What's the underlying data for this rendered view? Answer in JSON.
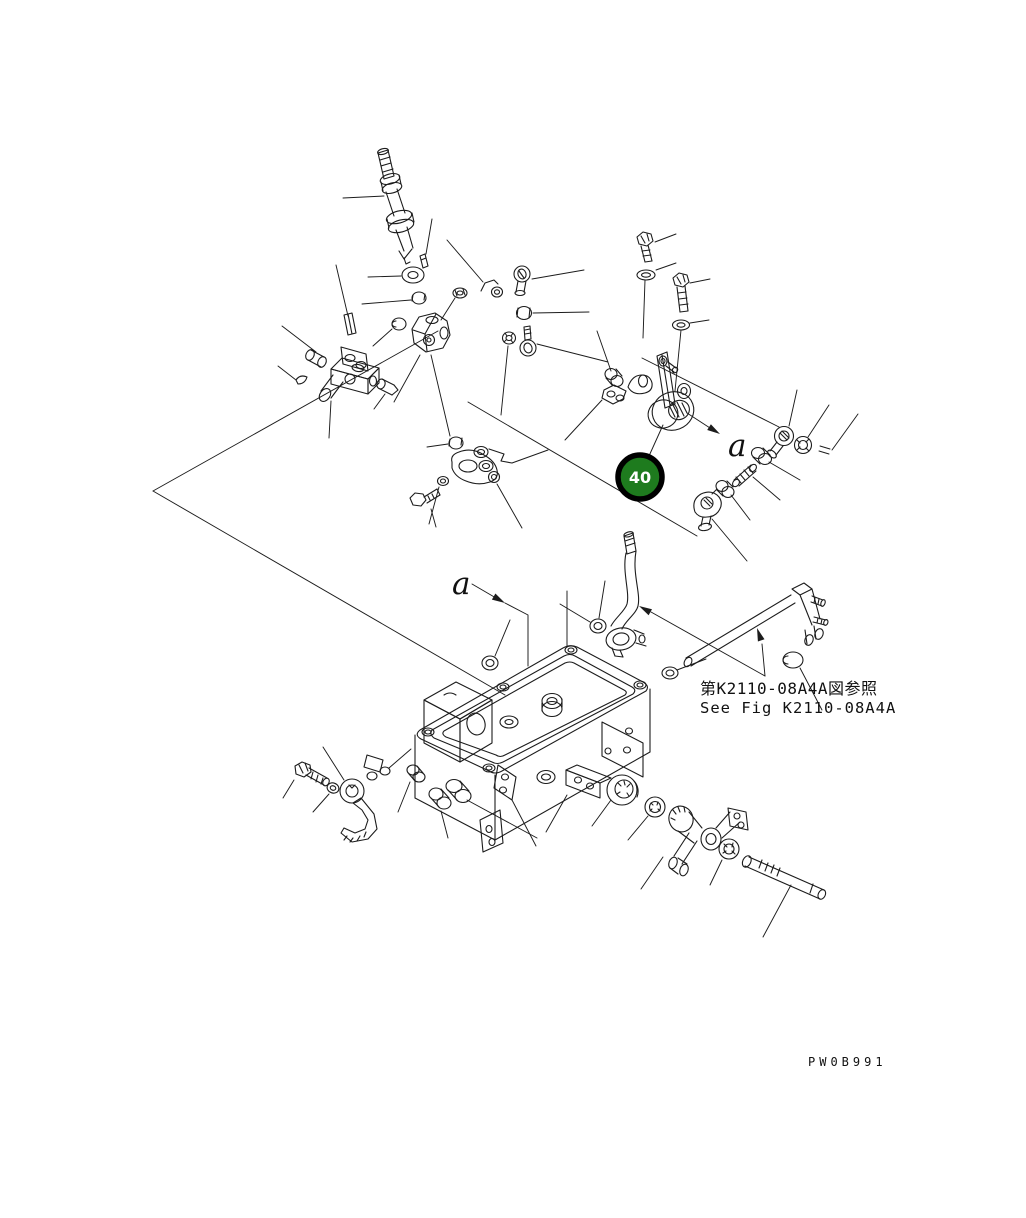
{
  "page": {
    "background": "#ffffff",
    "line_color": "#1c1c1c"
  },
  "balloon": {
    "number": "40",
    "fill": "#1E7B1E",
    "ring_color": "#000000",
    "text_color": "#ffffff"
  },
  "labels": {
    "section_a_upper": "a",
    "section_a_lower": "a"
  },
  "reference_note": {
    "japanese": "第K2110-08A4A図参照",
    "english": "See Fig K2110-08A4A"
  },
  "drawing_number": "PW0B991"
}
